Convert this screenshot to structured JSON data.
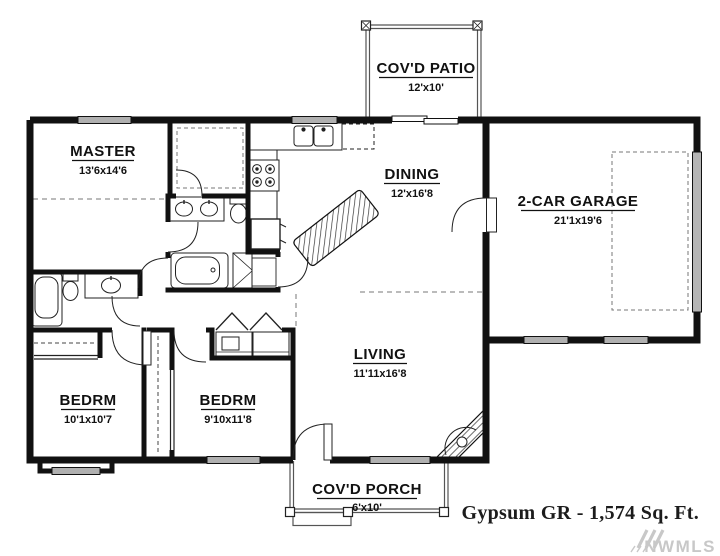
{
  "plan": {
    "rooms": [
      {
        "id": "master",
        "name": "MASTER",
        "dims": "13'6x14'6"
      },
      {
        "id": "covd-patio",
        "name": "COV'D PATIO",
        "dims": "12'x10'"
      },
      {
        "id": "dining",
        "name": "DINING",
        "dims": "12'x16'8"
      },
      {
        "id": "garage",
        "name": "2-CAR GARAGE",
        "dims": "21'1x19'6"
      },
      {
        "id": "living",
        "name": "LIVING",
        "dims": "11'11x16'8"
      },
      {
        "id": "bedroom-1",
        "name": "BEDRM",
        "dims": "10'1x10'7"
      },
      {
        "id": "bedroom-2",
        "name": "BEDRM",
        "dims": "9'10x11'8"
      },
      {
        "id": "covd-porch",
        "name": "COV'D PORCH",
        "dims": "6'x10'"
      }
    ],
    "footer": {
      "title": "Gypsum GR - 1,574 Sq. Ft."
    },
    "watermark": {
      "text": "NWMLS"
    },
    "colors": {
      "wall": "#111111",
      "window_fill": "#b0b0b0",
      "watermark": "#c8c8c8"
    }
  }
}
